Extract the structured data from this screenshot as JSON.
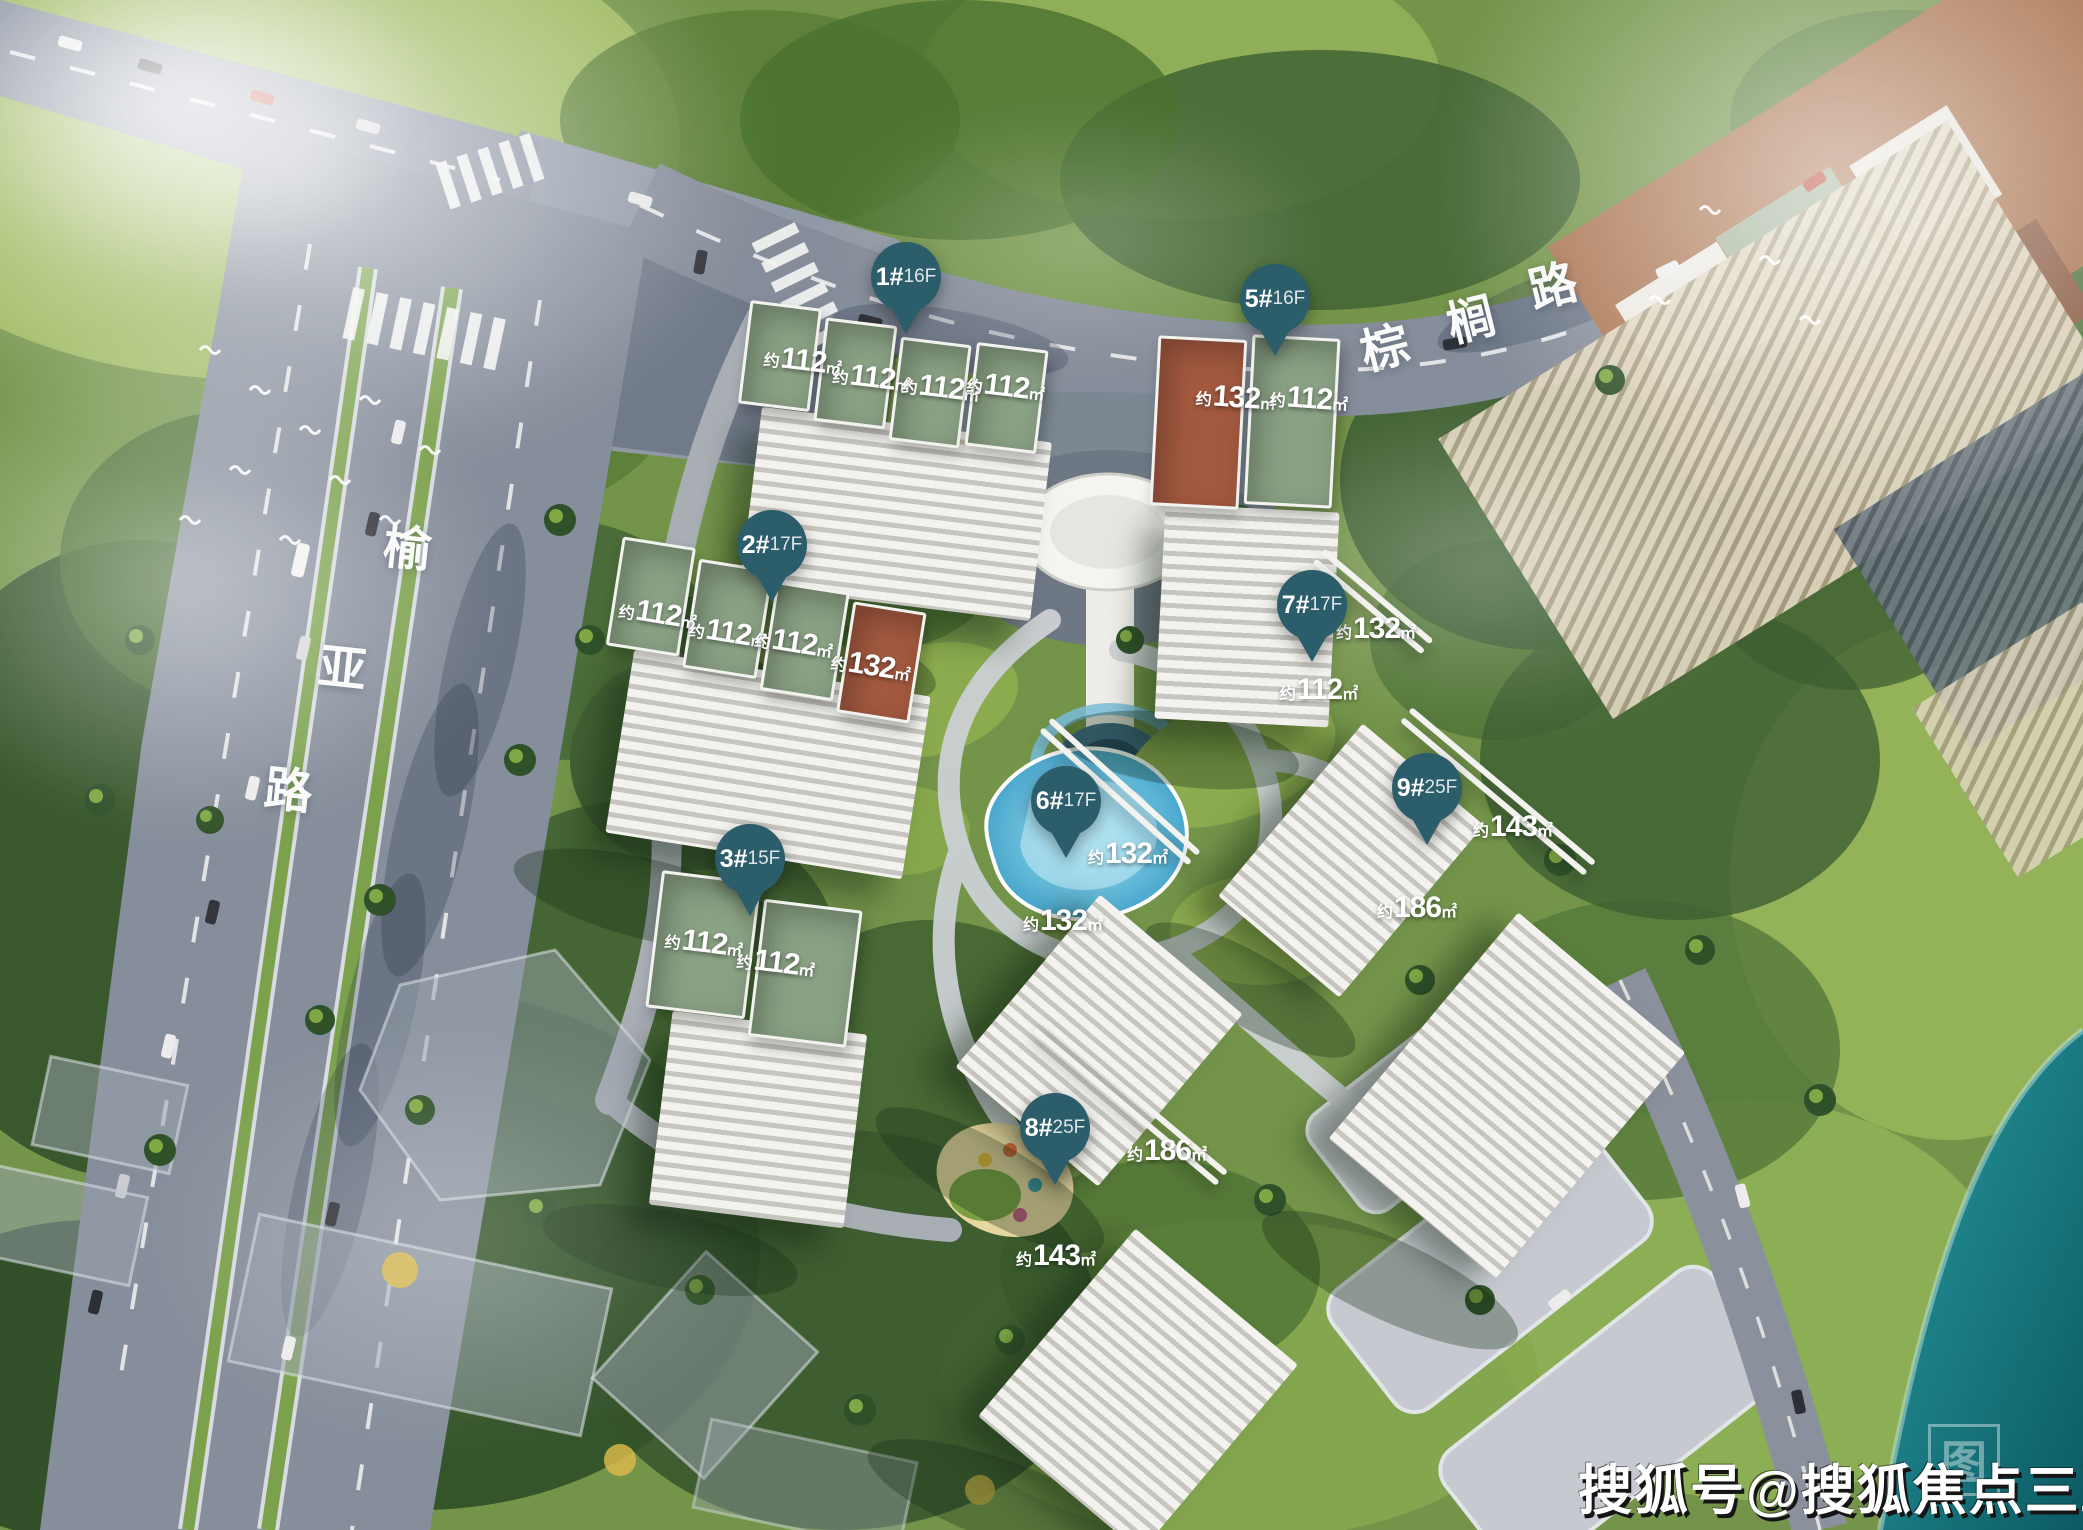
{
  "ui": {
    "approx_prefix": "约",
    "sqm_unit": "㎡"
  },
  "watermark": {
    "text": "搜狐号@搜狐焦点三亚站",
    "logo_glyph": "图"
  },
  "roads": {
    "palm_road": {
      "name": "棕榈路",
      "chars": [
        "棕",
        "榈",
        "路"
      ]
    },
    "yuya_road": {
      "name": "榆亚路",
      "chars": [
        "榆",
        "亚",
        "路"
      ]
    }
  },
  "colors": {
    "pin": "#2b5d6b",
    "roof_green": "#8aa184",
    "roof_terracotta": "#a2593f",
    "roof_darkred": "#a44f5e",
    "roof_purple": "#7b5174",
    "water": "#0f6b72",
    "pool": "#5fbcdd"
  },
  "buildings": [
    {
      "id": "1",
      "pin_num": "1#",
      "pin_floors": "16F",
      "units": [
        "112",
        "112",
        "112",
        "112"
      ]
    },
    {
      "id": "2",
      "pin_num": "2#",
      "pin_floors": "17F",
      "units": [
        "112",
        "112",
        "112",
        "132"
      ]
    },
    {
      "id": "3",
      "pin_num": "3#",
      "pin_floors": "15F",
      "units": [
        "112",
        "112"
      ]
    },
    {
      "id": "5",
      "pin_num": "5#",
      "pin_floors": "16F",
      "units": [
        "132",
        "112"
      ]
    },
    {
      "id": "6",
      "pin_num": "6#",
      "pin_floors": "17F",
      "units": [
        "132",
        "132"
      ]
    },
    {
      "id": "7",
      "pin_num": "7#",
      "pin_floors": "17F",
      "units": [
        "132",
        "112"
      ]
    },
    {
      "id": "8",
      "pin_num": "8#",
      "pin_floors": "25F",
      "units": [
        "186",
        "143"
      ]
    },
    {
      "id": "9",
      "pin_num": "9#",
      "pin_floors": "25F",
      "units": [
        "143",
        "186"
      ]
    }
  ]
}
